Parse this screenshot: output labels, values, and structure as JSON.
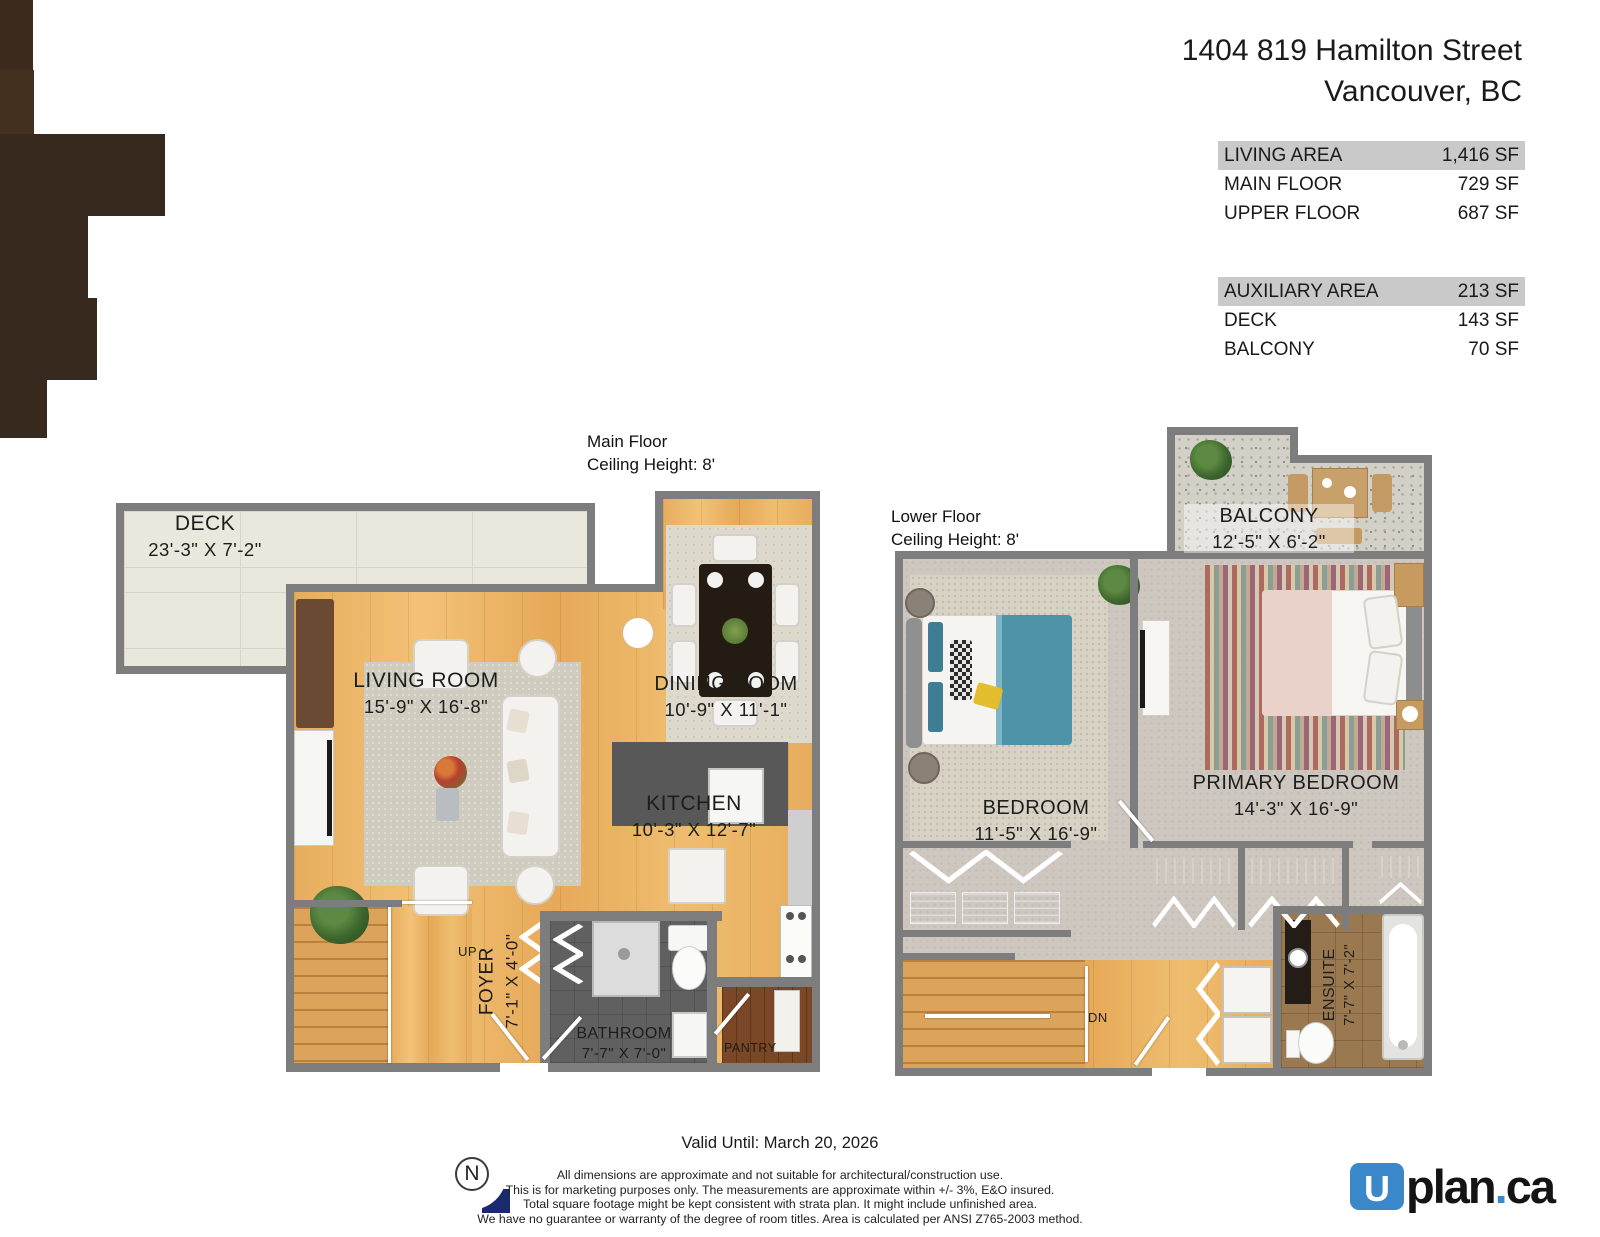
{
  "header": {
    "address_line1": "1404 819 Hamilton Street",
    "address_line2": "Vancouver, BC"
  },
  "area_tables": [
    {
      "rows": [
        {
          "label": "LIVING AREA",
          "value": "1,416 SF"
        },
        {
          "label": "MAIN FLOOR",
          "value": "729 SF"
        },
        {
          "label": "UPPER FLOOR",
          "value": "687 SF"
        }
      ]
    },
    {
      "rows": [
        {
          "label": "AUXILIARY AREA",
          "value": "213 SF"
        },
        {
          "label": "DECK",
          "value": "143 SF"
        },
        {
          "label": "BALCONY",
          "value": "70 SF"
        }
      ]
    }
  ],
  "main_floor": {
    "caption": [
      "Main Floor",
      "Ceiling Height: 8'"
    ],
    "rooms": {
      "deck": {
        "name": "DECK",
        "dims": "23'-3\" X 7'-2\""
      },
      "living_room": {
        "name": "LIVING ROOM",
        "dims": "15'-9\" X 16'-8\""
      },
      "dining_room": {
        "name": "DINING ROOM",
        "dims": "10'-9\" X 11'-1\""
      },
      "kitchen": {
        "name": "KITCHEN",
        "dims": "10'-3\" X 12'-7\""
      },
      "foyer": {
        "name": "FOYER",
        "dims": "7'-1\" X 4'-0\""
      },
      "bathroom": {
        "name": "BATHROOM",
        "dims": "7'-7\" X 7'-0\""
      },
      "pantry": {
        "name": "PANTRY"
      },
      "stairs": {
        "label": "UP"
      }
    }
  },
  "lower_floor": {
    "caption": [
      "Lower Floor",
      "Ceiling Height: 8'"
    ],
    "rooms": {
      "balcony": {
        "name": "BALCONY",
        "dims": "12'-5\" X 6'-2\""
      },
      "bedroom": {
        "name": "BEDROOM",
        "dims": "11'-5\" X 16'-9\""
      },
      "primary_bedroom": {
        "name": "PRIMARY BEDROOM",
        "dims": "14'-3\" X 16'-9\""
      },
      "ensuite": {
        "name": "ENSUITE",
        "dims": "7'-7\" X 7'-2\""
      },
      "stairs": {
        "label": "DN"
      }
    }
  },
  "footer": {
    "valid_until": "Valid Until: March 20, 2026",
    "disclaimer": [
      "All dimensions are approximate and not suitable for architectural/construction use.",
      "This is for marketing purposes only. The measurements are approximate within +/- 3%, E&O insured.",
      "Total square footage might be kept consistent with strata plan. It might include unfinished area.",
      "We have no guarantee or warranty of the degree of room titles. Area is calculated per ANSI Z765-2003 method."
    ],
    "north_label": "N",
    "logo": {
      "mark": "U",
      "text": "plan",
      "dot": ".",
      "tld": "ca"
    }
  },
  "colors": {
    "logo_blue": "#3a87c9",
    "table_header_gray": "#c9c9c9",
    "wall_gray": "#7d7d7d",
    "wood_floor": "#ecb466",
    "north_navy": "#1b2a6e"
  }
}
